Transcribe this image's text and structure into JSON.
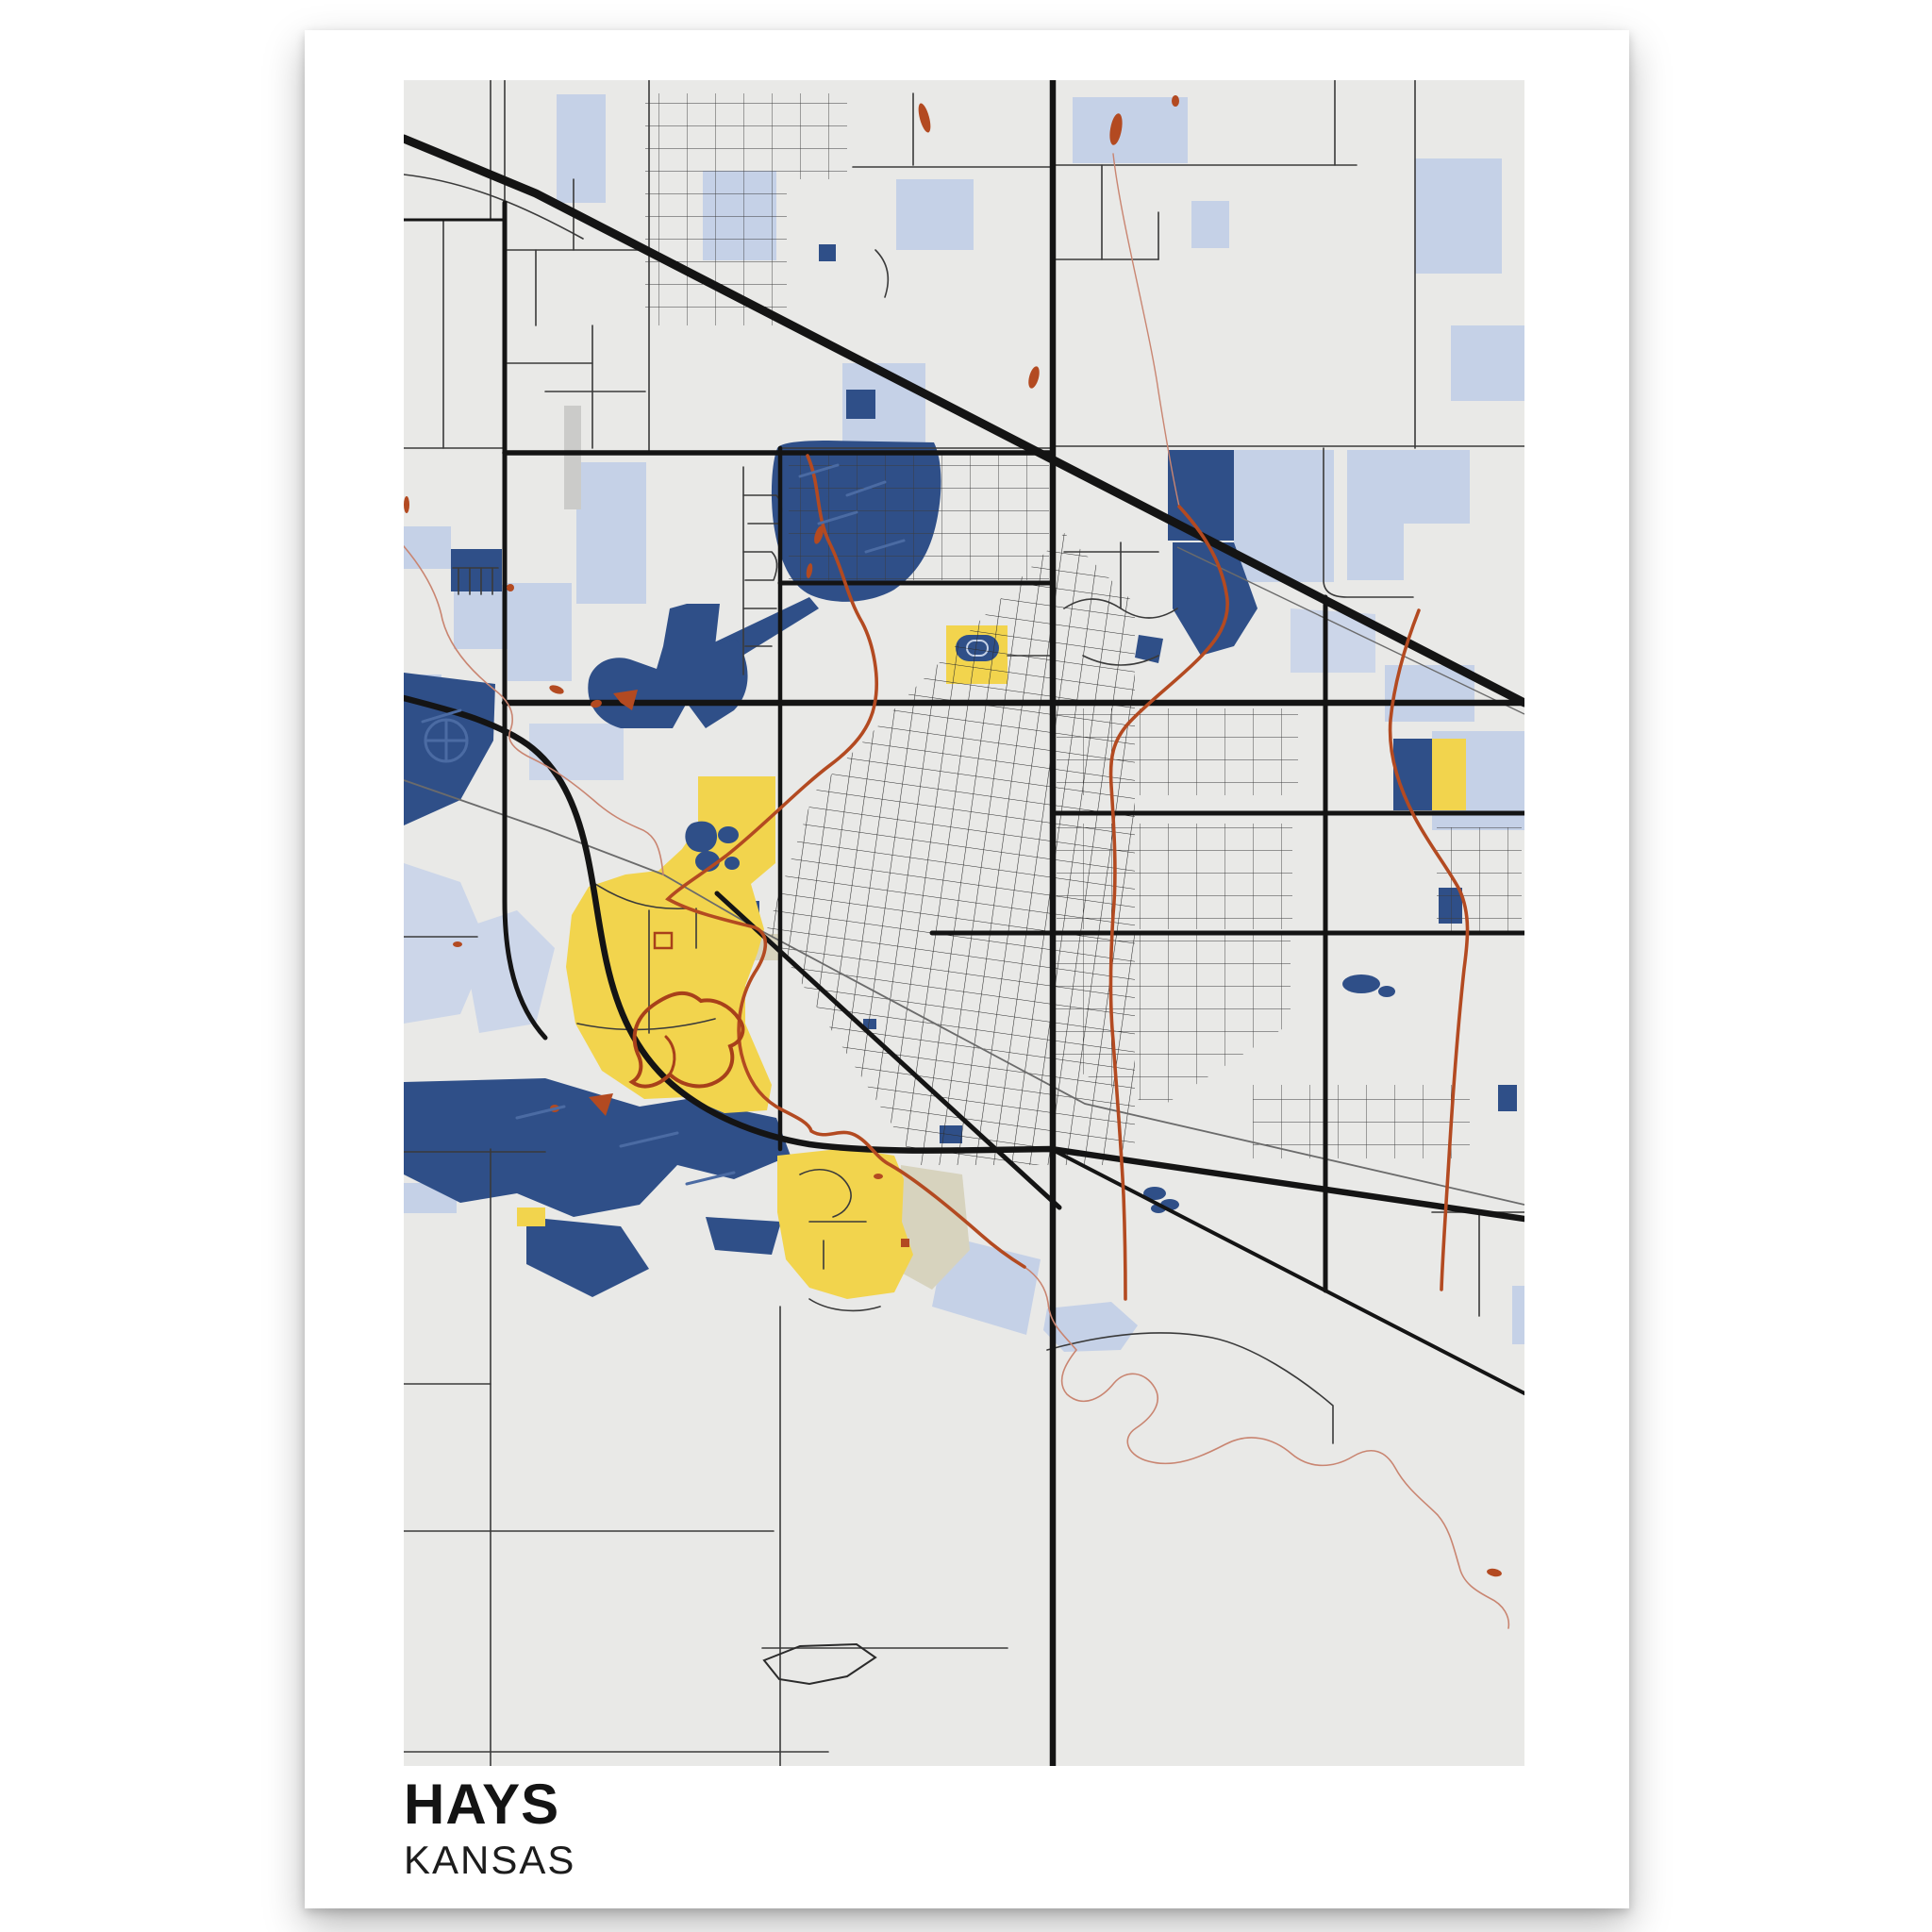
{
  "poster": {
    "title": "HAYS",
    "subtitle": "KANSAS"
  },
  "map": {
    "colors": {
      "map-bg": "#e9e9e7",
      "road-color": "#141414",
      "water-dark": "#2f4f88",
      "water-light": "#c5d1e7",
      "water-light2": "#ccd6e9",
      "landmark-yellow": "#f2d44d",
      "stream-red": "#b34a21",
      "stream-pink": "#c98571",
      "loop-maroon": "#a8401a",
      "railroad-gray": "#6b6b6b",
      "tan": "#d7d3be",
      "gray-strip": "#cbcbc9"
    }
  }
}
